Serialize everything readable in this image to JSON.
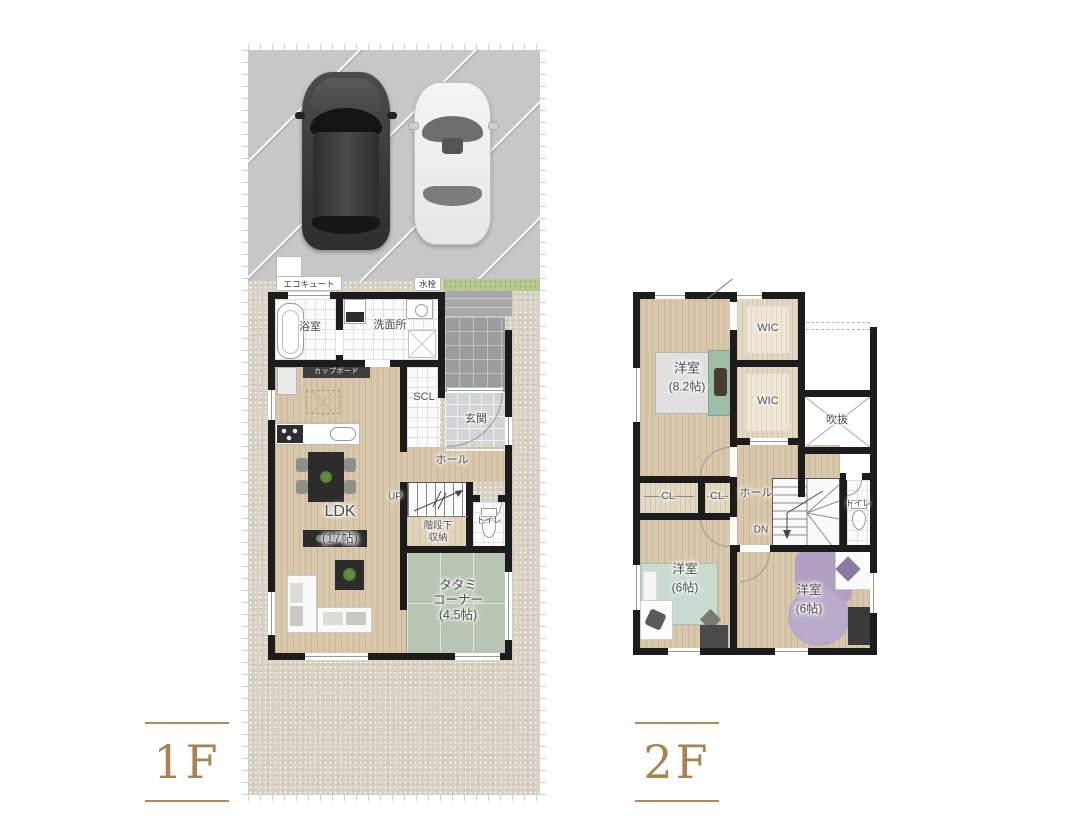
{
  "floor1": {
    "floor_label": "1F",
    "ecocute_label": "エコキュート",
    "faucet_label": "水栓",
    "bathroom": "浴室",
    "washroom": "洗面所",
    "cupboard": "カップボード",
    "shoe_closet": "SCL",
    "entrance": "玄関",
    "hall": "ホール",
    "stairs_direction": "UP",
    "toilet": "トイレ",
    "under_stair_storage": [
      "階段下",
      "収納"
    ],
    "ldk": {
      "name": "LDK",
      "size": "(17帖)"
    },
    "tatami_corner": {
      "name_line1": "タタミ",
      "name_line2": "コーナー",
      "size": "(4.5帖)"
    }
  },
  "floor2": {
    "floor_label": "2F",
    "bedroom_main": {
      "name": "洋室",
      "size": "(8.2帖)"
    },
    "wic_upper": "WIC",
    "wic_lower": "WIC",
    "void": "吹抜",
    "closet_left": "CL",
    "closet_right": "CL",
    "hall": "ホール",
    "stairs_direction": "DN",
    "toilet": "トイレ",
    "bedroom_left": {
      "name": "洋室",
      "size": "(6帖)"
    },
    "bedroom_right": {
      "name": "洋室",
      "size": "(6帖)"
    }
  },
  "colors": {
    "accent_brown": "#a9824f",
    "wall_black": "#1c1c1c",
    "wood_floor": "#d8c7ab",
    "tatami_green": "#b7c5b1",
    "parking_gray": "#c7c7c7",
    "gravel_beige": "#d8d1c3",
    "label_gray": "#4b4b4b"
  }
}
